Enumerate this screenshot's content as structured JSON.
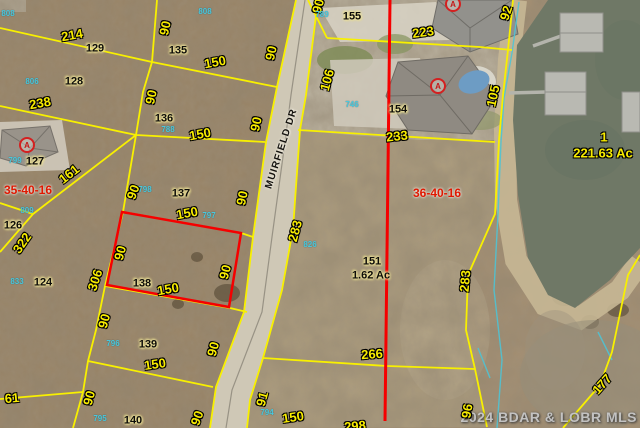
{
  "map": {
    "street": {
      "label": "MUIRFIELD DR",
      "x": 282,
      "y": 149,
      "rotate": -72
    },
    "watermark": {
      "text": "2024 BDAR & LOBR MLS"
    },
    "sections": [
      {
        "text": "35-40-16",
        "x": 28,
        "y": 190
      },
      {
        "text": "36-40-16",
        "x": 437,
        "y": 193
      }
    ],
    "lots": [
      {
        "text": "129",
        "x": 95,
        "y": 49
      },
      {
        "text": "135",
        "x": 178,
        "y": 51
      },
      {
        "text": "155",
        "x": 352,
        "y": 17
      },
      {
        "text": "128",
        "x": 74,
        "y": 82
      },
      {
        "text": "136",
        "x": 164,
        "y": 119
      },
      {
        "text": "154",
        "x": 398,
        "y": 110
      },
      {
        "text": "127",
        "x": 35,
        "y": 162
      },
      {
        "text": "137",
        "x": 181,
        "y": 194
      },
      {
        "text": "126",
        "x": 13,
        "y": 226
      },
      {
        "text": "124",
        "x": 43,
        "y": 283
      },
      {
        "text": "138",
        "x": 142,
        "y": 284
      },
      {
        "text": "139",
        "x": 148,
        "y": 345
      },
      {
        "text": "140",
        "x": 133,
        "y": 421
      },
      {
        "text": "151",
        "x": 372,
        "y": 262
      },
      {
        "text": "1.62 Ac",
        "x": 371,
        "y": 276
      }
    ],
    "dimensions": [
      {
        "text": "214",
        "x": 72,
        "y": 35,
        "r": -10
      },
      {
        "text": "150",
        "x": 215,
        "y": 62,
        "r": -10
      },
      {
        "text": "90",
        "x": 165,
        "y": 28,
        "r": -78
      },
      {
        "text": "90",
        "x": 318,
        "y": 6,
        "r": -75
      },
      {
        "text": "90",
        "x": 271,
        "y": 53,
        "r": -78
      },
      {
        "text": "223",
        "x": 423,
        "y": 32,
        "r": -8
      },
      {
        "text": "92",
        "x": 506,
        "y": 13,
        "r": -72
      },
      {
        "text": "238",
        "x": 40,
        "y": 103,
        "r": -10
      },
      {
        "text": "90",
        "x": 151,
        "y": 97,
        "r": -78
      },
      {
        "text": "150",
        "x": 200,
        "y": 134,
        "r": -10
      },
      {
        "text": "90",
        "x": 256,
        "y": 124,
        "r": -78
      },
      {
        "text": "106",
        "x": 327,
        "y": 80,
        "r": -75
      },
      {
        "text": "105",
        "x": 493,
        "y": 96,
        "r": -78
      },
      {
        "text": "233",
        "x": 397,
        "y": 136,
        "r": -6
      },
      {
        "text": "161",
        "x": 69,
        "y": 174,
        "r": -38
      },
      {
        "text": "90",
        "x": 133,
        "y": 192,
        "r": -70
      },
      {
        "text": "90",
        "x": 242,
        "y": 198,
        "r": -78
      },
      {
        "text": "322",
        "x": 22,
        "y": 243,
        "r": -55
      },
      {
        "text": "306",
        "x": 95,
        "y": 280,
        "r": -72
      },
      {
        "text": "150",
        "x": 187,
        "y": 213,
        "r": -10
      },
      {
        "text": "90",
        "x": 120,
        "y": 253,
        "r": -75
      },
      {
        "text": "90",
        "x": 225,
        "y": 272,
        "r": -75
      },
      {
        "text": "150",
        "x": 168,
        "y": 289,
        "r": -10
      },
      {
        "text": "283",
        "x": 295,
        "y": 231,
        "r": -75
      },
      {
        "text": "283",
        "x": 465,
        "y": 281,
        "r": -85
      },
      {
        "text": "90",
        "x": 104,
        "y": 321,
        "r": -75
      },
      {
        "text": "150",
        "x": 155,
        "y": 364,
        "r": -8
      },
      {
        "text": "90",
        "x": 213,
        "y": 349,
        "r": -75
      },
      {
        "text": "266",
        "x": 372,
        "y": 354,
        "r": -4
      },
      {
        "text": "61",
        "x": 12,
        "y": 398,
        "r": -5
      },
      {
        "text": "90",
        "x": 89,
        "y": 398,
        "r": -75
      },
      {
        "text": "91",
        "x": 262,
        "y": 399,
        "r": -75
      },
      {
        "text": "90",
        "x": 197,
        "y": 418,
        "r": -70
      },
      {
        "text": "150",
        "x": 293,
        "y": 417,
        "r": -8
      },
      {
        "text": "96",
        "x": 467,
        "y": 411,
        "r": -80
      },
      {
        "text": "177",
        "x": 602,
        "y": 384,
        "r": -48
      },
      {
        "text": "298",
        "x": 355,
        "y": 426,
        "r": -5
      },
      {
        "text": "1",
        "x": 604,
        "y": 137,
        "r": 0
      },
      {
        "text": "221.63 Ac",
        "x": 603,
        "y": 153,
        "r": 0
      }
    ],
    "parcel_ids": [
      {
        "text": "808",
        "x": 8,
        "y": 14
      },
      {
        "text": "806",
        "x": 32,
        "y": 82
      },
      {
        "text": "808",
        "x": 205,
        "y": 12
      },
      {
        "text": "789",
        "x": 322,
        "y": 15
      },
      {
        "text": "788",
        "x": 168,
        "y": 130
      },
      {
        "text": "798",
        "x": 145,
        "y": 190
      },
      {
        "text": "799",
        "x": 15,
        "y": 161
      },
      {
        "text": "809",
        "x": 27,
        "y": 211
      },
      {
        "text": "833",
        "x": 17,
        "y": 282
      },
      {
        "text": "797",
        "x": 209,
        "y": 216
      },
      {
        "text": "796",
        "x": 113,
        "y": 344
      },
      {
        "text": "795",
        "x": 100,
        "y": 419
      },
      {
        "text": "794",
        "x": 267,
        "y": 413
      },
      {
        "text": "746",
        "x": 352,
        "y": 105
      },
      {
        "text": "826",
        "x": 310,
        "y": 245
      }
    ],
    "markers": [
      {
        "label": "A",
        "x": 27,
        "y": 145
      },
      {
        "label": "A",
        "x": 453,
        "y": 4
      },
      {
        "label": "A",
        "x": 438,
        "y": 86
      }
    ],
    "colors": {
      "parcel_line": "#f8f000",
      "highlight_outline": "#f50000",
      "section_line": "#f50000",
      "parcel_id_text": "#4ac8dc",
      "dimension_text": "#f8ec00",
      "lot_text": "#0d0c08",
      "section_text": "#e01800",
      "water": "#6f7866",
      "road": "#cfc8b6"
    }
  }
}
